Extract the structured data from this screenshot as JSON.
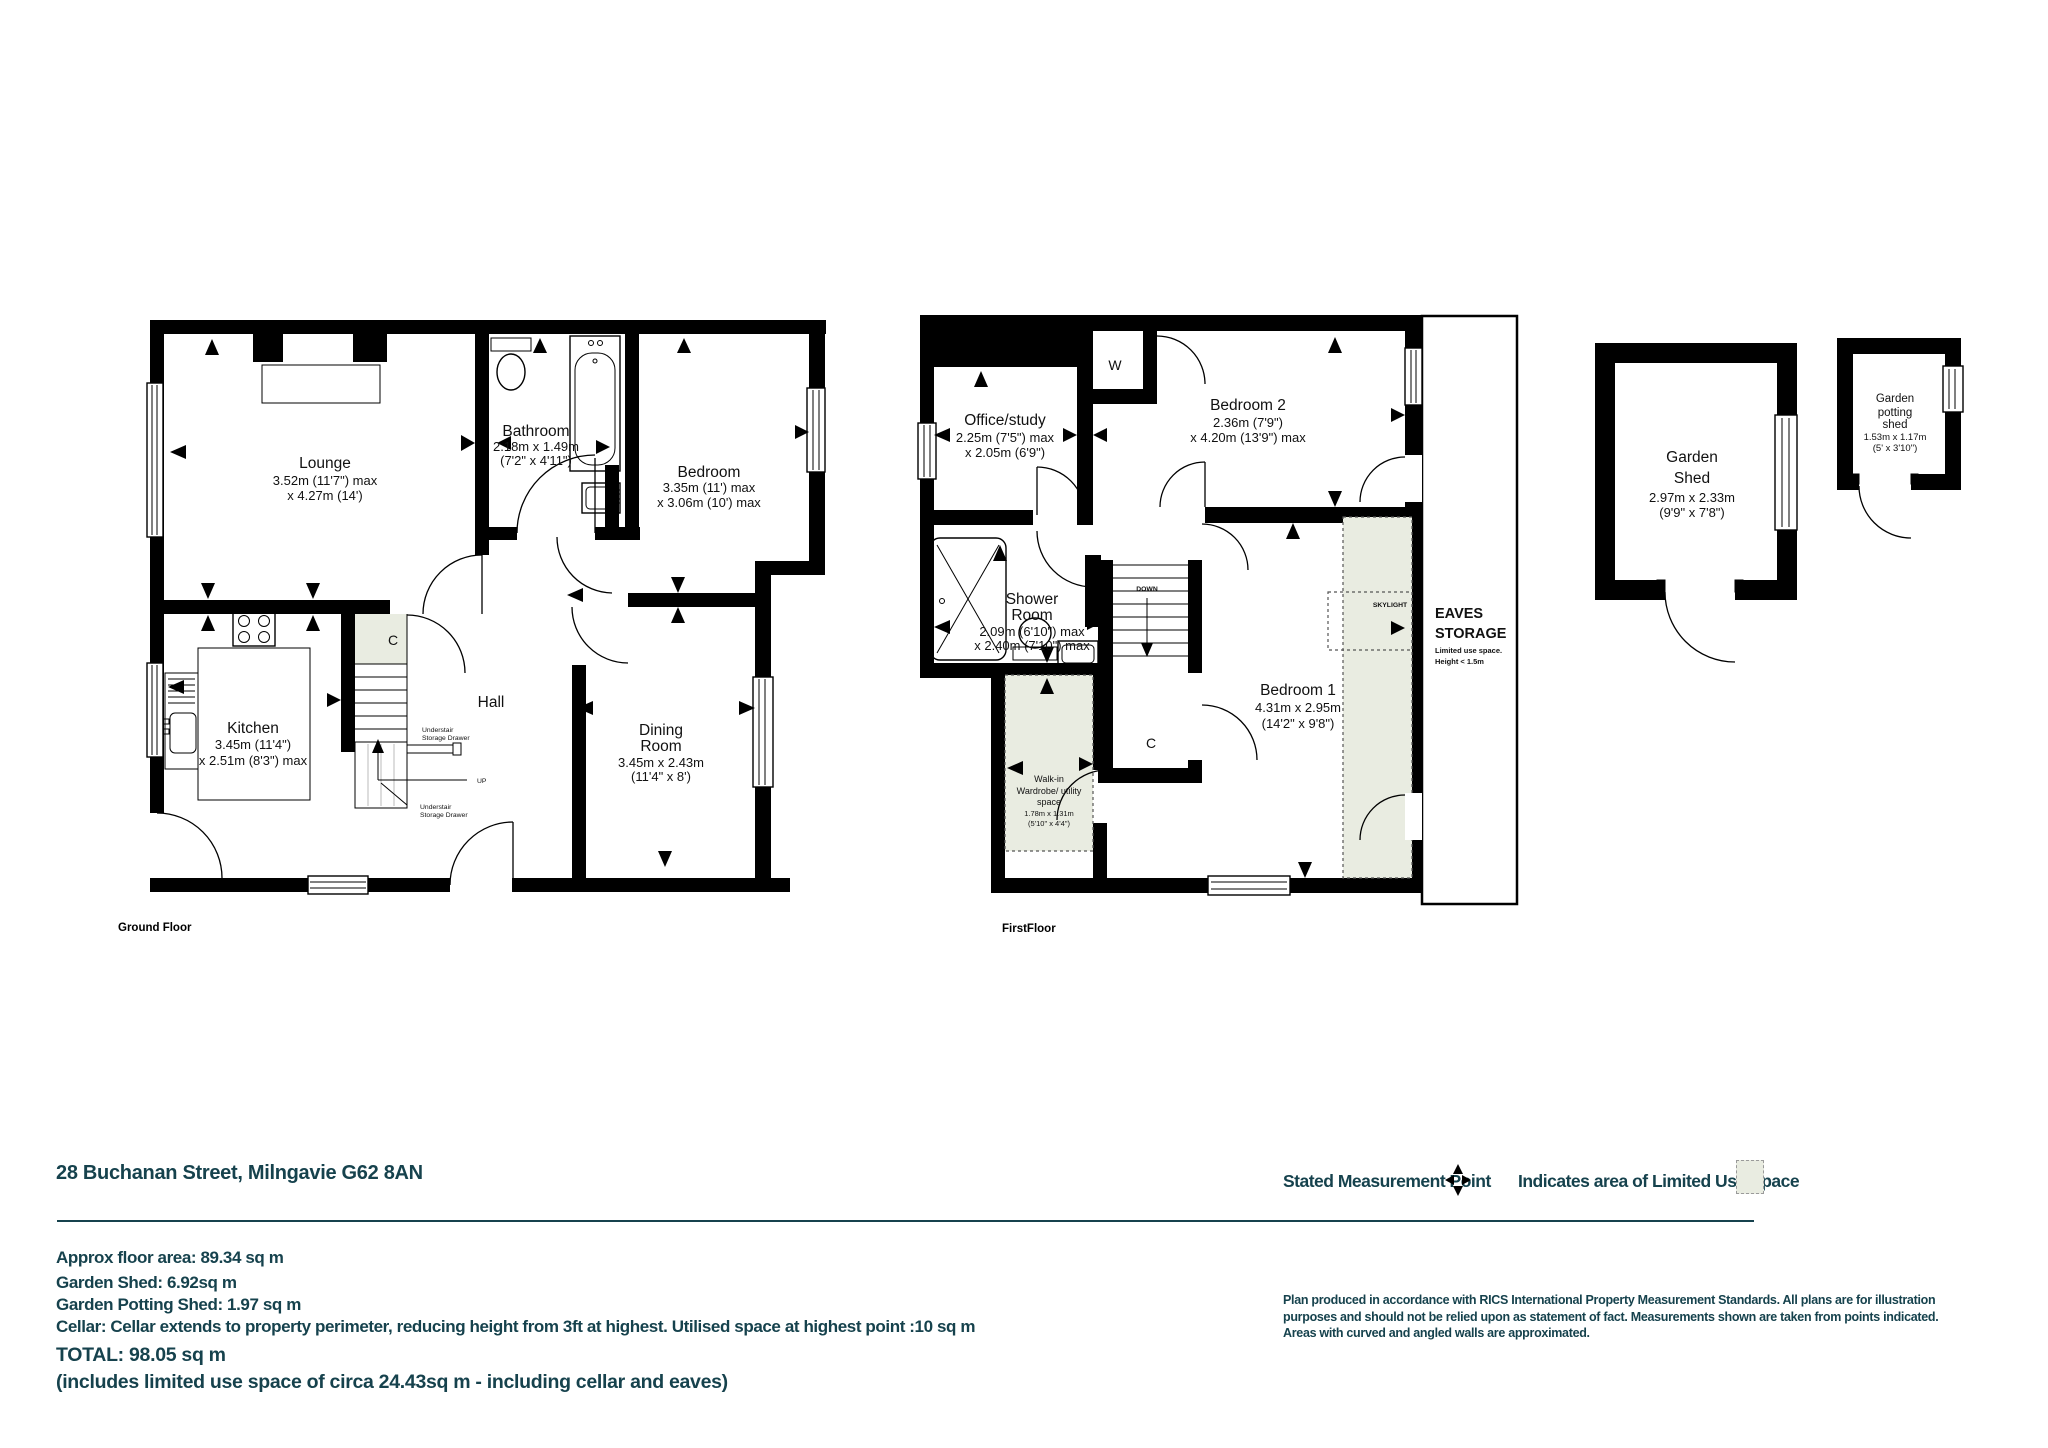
{
  "header": {
    "address": "28 Buchanan Street, Milngavie G62 8AN"
  },
  "legend": {
    "measurement_point": "Stated Measurement Point",
    "limited_use": "Indicates area of  Limited Use Space"
  },
  "summary": {
    "approx": "Approx floor area: 89.34 sq m",
    "shed": "Garden Shed: 6.92sq m",
    "potting": "Garden Potting Shed: 1.97 sq m",
    "cellar": "Cellar: Cellar extends to property perimeter, reducing height from 3ft at highest.  Utilised space at highest point :10 sq m",
    "total": "TOTAL: 98.05 sq m",
    "includes": "(includes limited use space of circa 24.43sq m - including cellar and eaves)"
  },
  "disclaimer": {
    "l1": "Plan produced  in accordance with RICS International Property  Measurement Standards.  All plans are for illustration",
    "l2": "purposes and should not be relied upon as statement of fact.  Measurements shown are taken from points indicated.",
    "l3": "Areas with curved and angled walls are approximated."
  },
  "ground_floor": {
    "label": "Ground Floor",
    "lounge": {
      "name": "Lounge",
      "dim1": "3.52m (11'7\") max",
      "dim2": "x 4.27m (14')"
    },
    "bathroom": {
      "name": "Bathroom",
      "dim1": "2.18m x 1.49m",
      "dim2": "(7'2\" x 4'11\")"
    },
    "bedroom": {
      "name": "Bedroom",
      "dim1": "3.35m (11') max",
      "dim2": "x 3.06m (10') max"
    },
    "kitchen": {
      "name": "Kitchen",
      "dim1": "3.45m (11'4\")",
      "dim2": "x 2.51m (8'3\") max"
    },
    "hall": {
      "name": "Hall"
    },
    "dining": {
      "line1": "Dining",
      "line2": "Room",
      "dim1": "3.45m x 2.43m",
      "dim2": "(11'4\" x 8')"
    },
    "cupboard": "C",
    "up": "UP",
    "understair_top": {
      "l1": "Understair",
      "l2": "Storage Drawer"
    },
    "understair_bottom": {
      "l1": "Understair",
      "l2": "Storage Drawer"
    }
  },
  "first_floor": {
    "label": "FirstFloor",
    "office": {
      "name": "Office/study",
      "dim1": "2.25m (7'5\") max",
      "dim2": "x 2.05m (6'9\")"
    },
    "bedroom2": {
      "name": "Bedroom 2",
      "dim1": "2.36m (7'9\")",
      "dim2": "x 4.20m (13'9\") max"
    },
    "shower": {
      "line1": "Shower",
      "line2": "Room",
      "dim1": "2.09m (6'10\") max",
      "dim2": "x 2.40m (7'10\") max"
    },
    "bedroom1": {
      "name": "Bedroom 1",
      "dim1": "4.31m x 2.95m",
      "dim2": "(14'2\" x 9'8\")"
    },
    "eaves": {
      "line1": "EAVES",
      "line2": "STORAGE",
      "note1": "Limited use space.",
      "note2": "Height < 1.5m"
    },
    "skylight": "SKYLIGHT",
    "walk_in": {
      "l1": "Walk-in",
      "l2": "Wardrobe/ utility",
      "l3": "space",
      "dim1": "1.78m x 1.31m",
      "dim2": "(5'10\" x 4'4\")"
    },
    "wardrobe": "W",
    "cupboard": "C",
    "down": "DOWN"
  },
  "outbuildings": {
    "garden_shed": {
      "line1": "Garden",
      "line2": "Shed",
      "dim1": "2.97m x 2.33m",
      "dim2": "(9'9\" x 7'8\")"
    },
    "potting_shed": {
      "line1": "Garden",
      "line2": "potting",
      "line3": "shed",
      "dim1": "1.53m x 1.17m",
      "dim2": "(5' x 3'10\")"
    }
  },
  "colors": {
    "teal": "#16424d",
    "limited_use_fill": "#e9ece1",
    "wall": "#000000"
  }
}
